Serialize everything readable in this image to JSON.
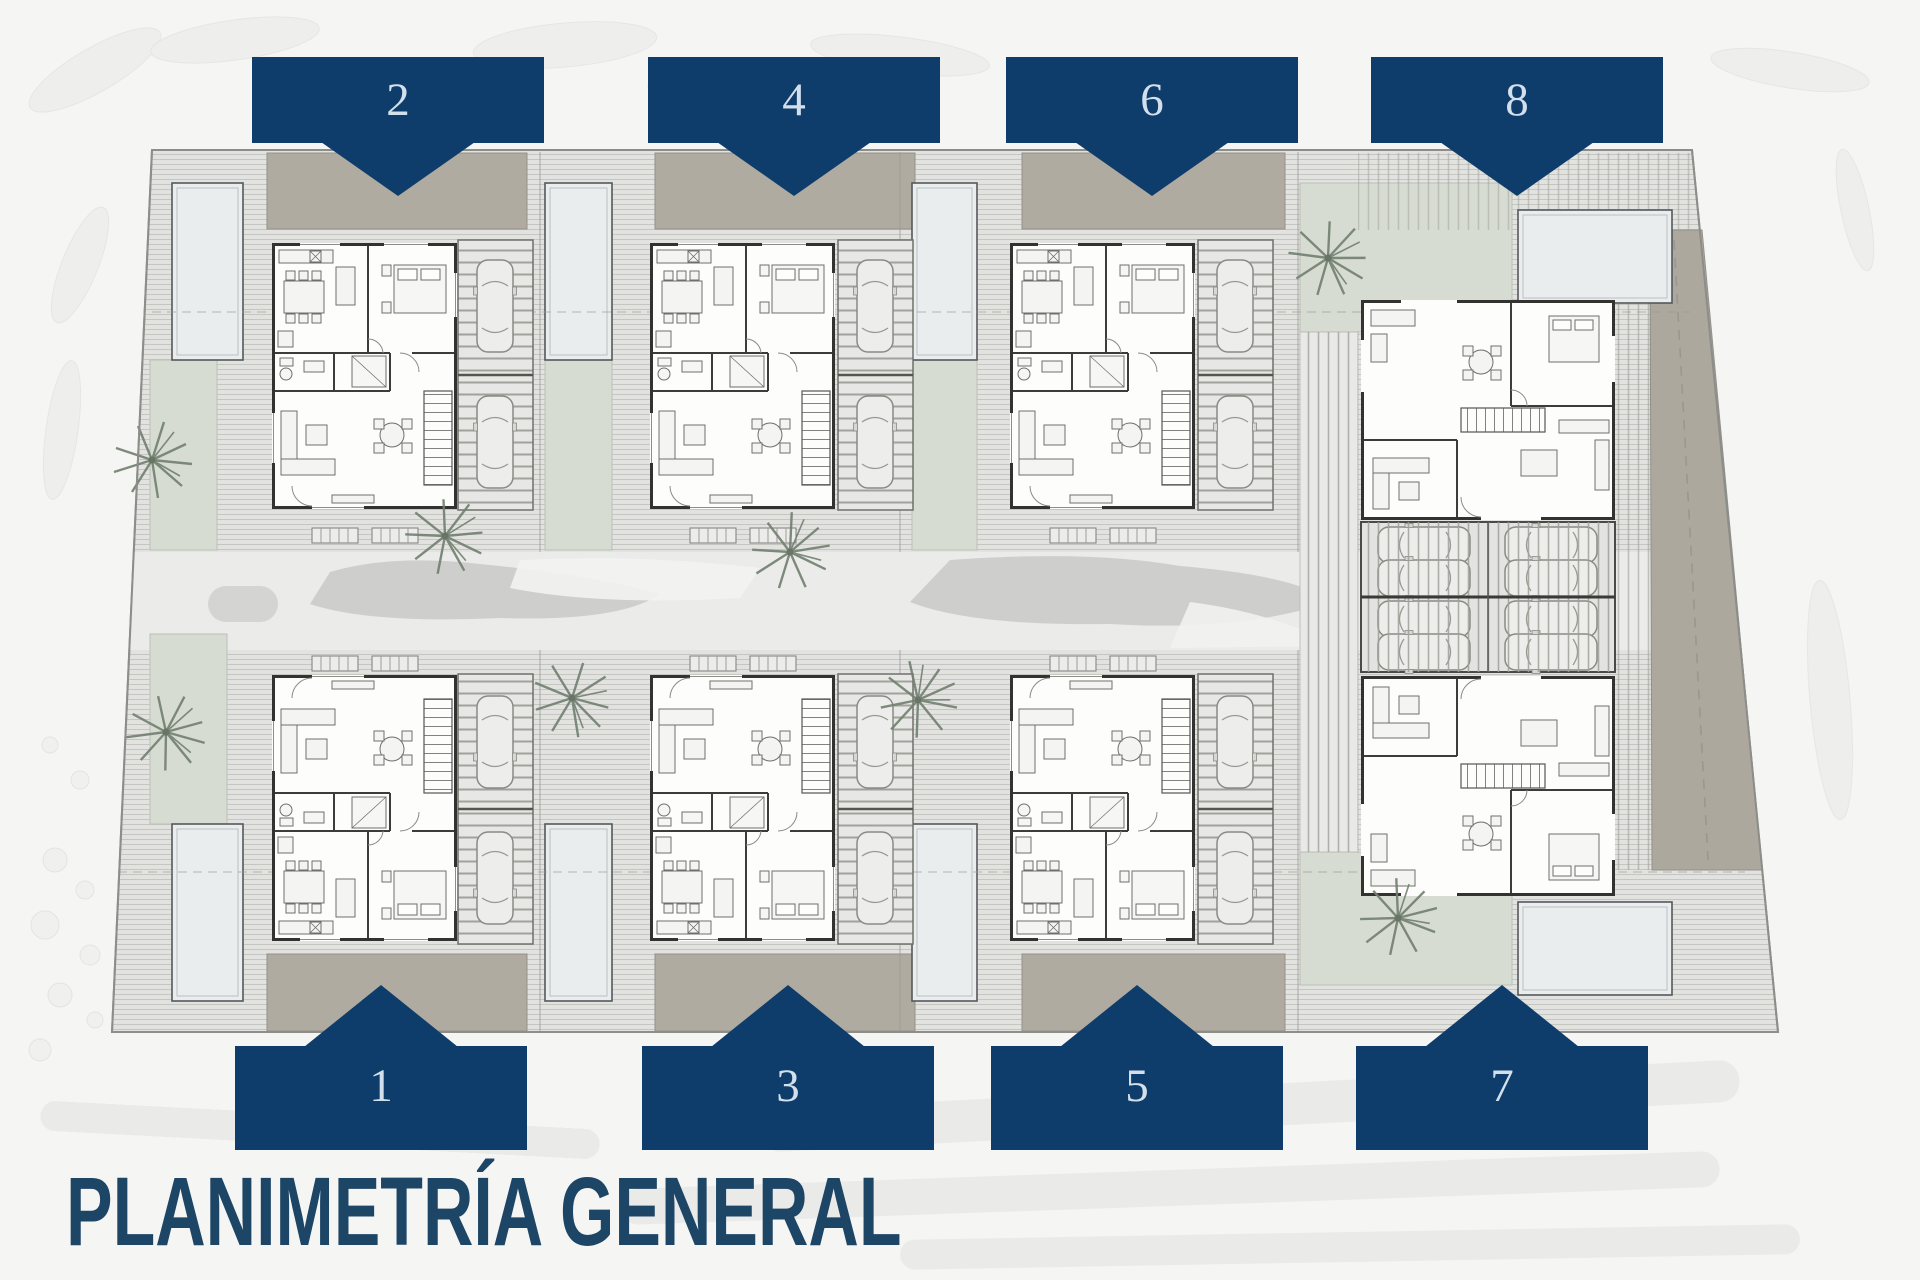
{
  "page": {
    "title": "PLANIMETRÍA GENERAL",
    "type": "architectural-site-plan"
  },
  "plan": {
    "units": [
      {
        "label": "1",
        "marker_direction": "up"
      },
      {
        "label": "2",
        "marker_direction": "down"
      },
      {
        "label": "3",
        "marker_direction": "up"
      },
      {
        "label": "4",
        "marker_direction": "down"
      },
      {
        "label": "5",
        "marker_direction": "up"
      },
      {
        "label": "6",
        "marker_direction": "down"
      },
      {
        "label": "7",
        "marker_direction": "up"
      },
      {
        "label": "8",
        "marker_direction": "down"
      }
    ]
  },
  "colors": {
    "banner_navy": "#0e3c6b",
    "banner_number": "#d3e0ec",
    "title_navy": "#1d4566",
    "site_base": "#e4e5e3",
    "deck_stripe": "#c6c6c1",
    "taupe": "#b0aba0",
    "lawn_sage": "#d7dcd3",
    "pool_fill": "#eaedee",
    "wall_dark": "#323230",
    "road_gray": "#ebecea",
    "palm_green": "#72806f",
    "car_body": "#ededeb"
  }
}
